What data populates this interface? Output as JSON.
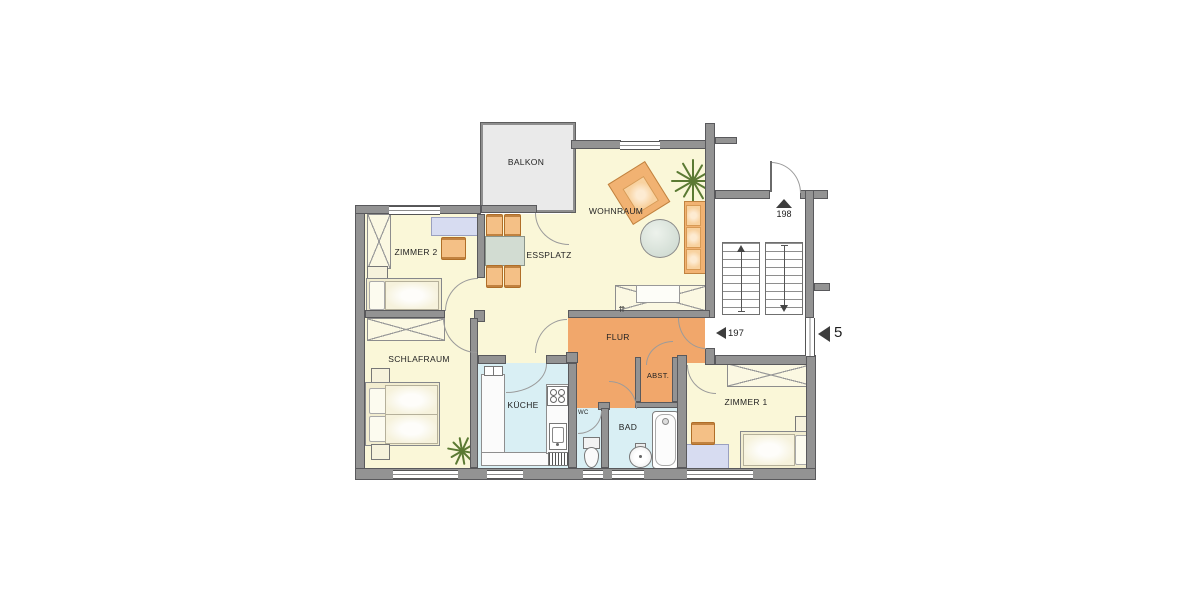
{
  "plan": {
    "rooms": {
      "balkon": {
        "label": "BALKON"
      },
      "wohnraum": {
        "label": "WOHNRAUM"
      },
      "essplatz": {
        "label": "ESSPLATZ"
      },
      "zimmer2": {
        "label": "ZIMMER 2"
      },
      "schlafraum": {
        "label": "SCHLAFRAUM"
      },
      "kueche": {
        "label": "KÜCHE"
      },
      "flur": {
        "label": "FLUR"
      },
      "abstellraum": {
        "label": "ABST."
      },
      "wc": {
        "label": "WC"
      },
      "bad": {
        "label": "BAD"
      },
      "zimmer1": {
        "label": "ZIMMER 1"
      }
    },
    "markers": {
      "stair_top": "198",
      "stair_bottom": "197",
      "unit_number": "5"
    },
    "icons": {
      "flur_arrows": "⇈"
    },
    "colors": {
      "floor": "#FAF7D8",
      "hall": "#F1A76B",
      "wet_rooms": "#D9EFF4",
      "balcony": "#EAEAEA",
      "wall": "#939393",
      "furniture_accent": "#F4C086"
    }
  }
}
